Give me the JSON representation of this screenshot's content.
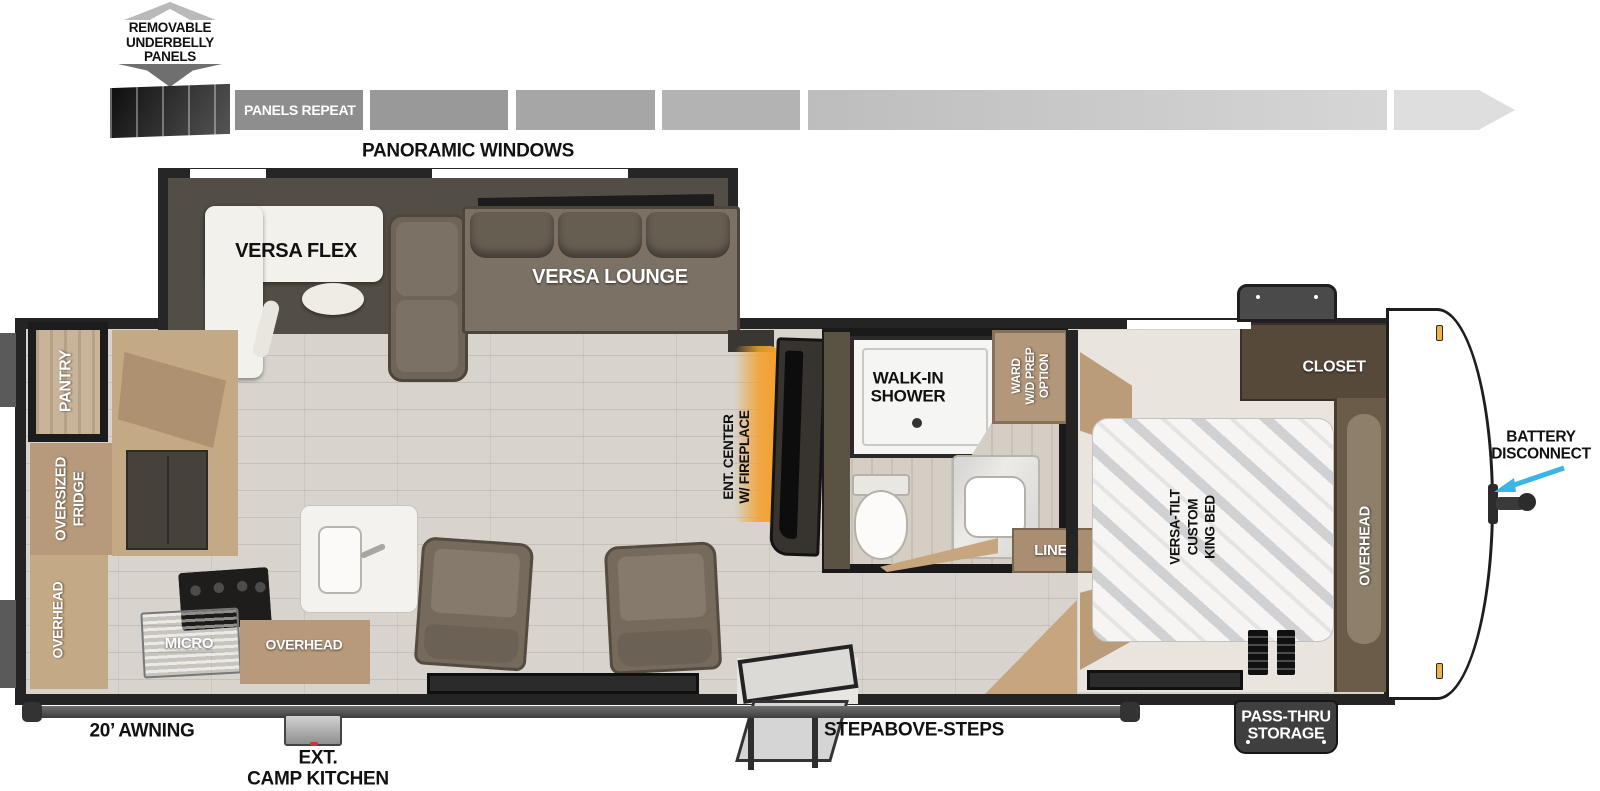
{
  "labels": {
    "underbelly": "REMOVABLE\nUNDERBELLY\nPANELS",
    "panels_repeat": "PANELS\nREPEAT",
    "panoramic_windows": "PANORAMIC WINDOWS",
    "versa_flex": "VERSA FLEX",
    "versa_lounge": "VERSA LOUNGE",
    "pantry": "PANTRY",
    "oversized_fridge": "OVERSIZED\nFRIDGE",
    "overhead_rear": "OVERHEAD",
    "micro": "MICRO",
    "overhead_kitchen": "OVERHEAD",
    "ent_center": "ENT. CENTER\nW/ FIREPLACE",
    "walk_in_shower": "WALK-IN\nSHOWER",
    "ward": "WARD\nW/D PREP\nOPTION",
    "linen": "LINEN",
    "king_bed": "VERSA-TILT\nCUSTOM\nKING BED",
    "closet": "CLOSET",
    "overhead_bedroom": "OVERHEAD",
    "battery_disconnect": "BATTERY\nDISCONNECT",
    "pass_thru": "PASS-THRU\nSTORAGE",
    "steps": "STEPABOVE-STEPS",
    "awning": "20’ AWNING",
    "camp_kitchen": "EXT.\nCAMP KITCHEN"
  },
  "colors": {
    "battery_arrow_accent": "#3ab5e6",
    "fireplace_glow": "#f49f2e",
    "wall": "#242424",
    "floor": "#d8d4cd",
    "slide_floor": "#524d45",
    "cabinet_tan": "#b79a7b",
    "closet_brown": "#57493a",
    "sofa_brown": "#7b7164"
  }
}
